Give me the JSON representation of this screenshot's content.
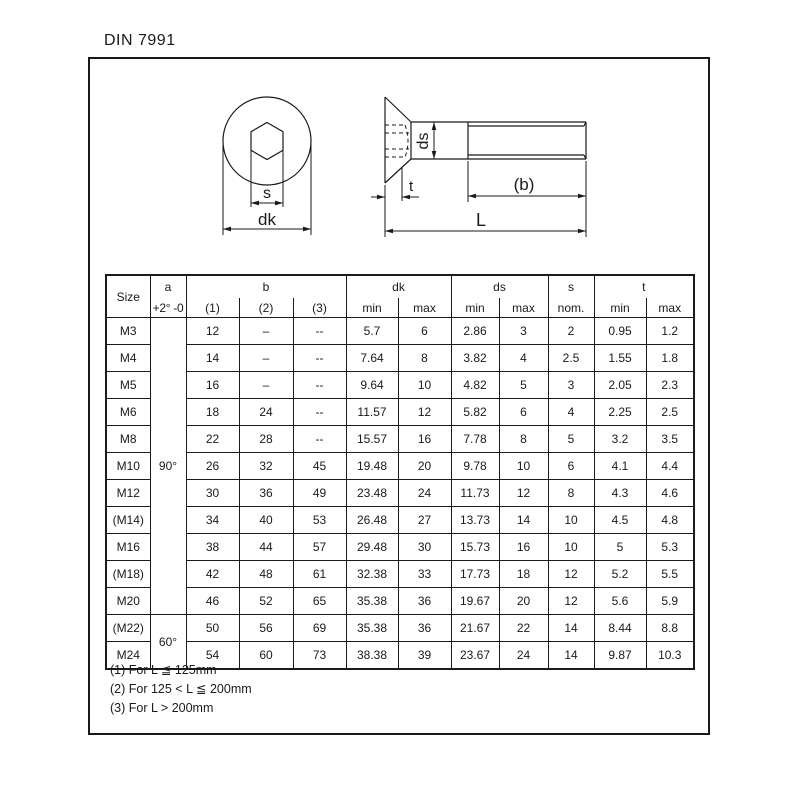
{
  "title": "DIN 7991",
  "drawing": {
    "top_view": {
      "s": "s",
      "dk": "dk"
    },
    "side_view": {
      "ds": "ds",
      "t": "t",
      "b": "(b)",
      "L": "L"
    }
  },
  "table": {
    "headers": {
      "size": "Size",
      "a": "a",
      "a_sub": "+2° -0",
      "b": "b",
      "b_subs": [
        "(1)",
        "(2)",
        "(3)"
      ],
      "dk": "dk",
      "ds": "ds",
      "s": "s",
      "t": "t",
      "minmax": [
        "min",
        "max"
      ],
      "s_sub": "nom."
    },
    "a_groups": [
      {
        "label": "90°",
        "rows": 11
      },
      {
        "label": "60°",
        "rows": 2
      }
    ],
    "rows": [
      {
        "size": "M3",
        "b1": "12",
        "b2": "–",
        "b3": "--",
        "dk_min": "5.7",
        "dk_max": "6",
        "ds_min": "2.86",
        "ds_max": "3",
        "s": "2",
        "t_min": "0.95",
        "t_max": "1.2"
      },
      {
        "size": "M4",
        "b1": "14",
        "b2": "–",
        "b3": "--",
        "dk_min": "7.64",
        "dk_max": "8",
        "ds_min": "3.82",
        "ds_max": "4",
        "s": "2.5",
        "t_min": "1.55",
        "t_max": "1.8"
      },
      {
        "size": "M5",
        "b1": "16",
        "b2": "–",
        "b3": "--",
        "dk_min": "9.64",
        "dk_max": "10",
        "ds_min": "4.82",
        "ds_max": "5",
        "s": "3",
        "t_min": "2.05",
        "t_max": "2.3"
      },
      {
        "size": "M6",
        "b1": "18",
        "b2": "24",
        "b3": "--",
        "dk_min": "11.57",
        "dk_max": "12",
        "ds_min": "5.82",
        "ds_max": "6",
        "s": "4",
        "t_min": "2.25",
        "t_max": "2.5"
      },
      {
        "size": "M8",
        "b1": "22",
        "b2": "28",
        "b3": "--",
        "dk_min": "15.57",
        "dk_max": "16",
        "ds_min": "7.78",
        "ds_max": "8",
        "s": "5",
        "t_min": "3.2",
        "t_max": "3.5"
      },
      {
        "size": "M10",
        "b1": "26",
        "b2": "32",
        "b3": "45",
        "dk_min": "19.48",
        "dk_max": "20",
        "ds_min": "9.78",
        "ds_max": "10",
        "s": "6",
        "t_min": "4.1",
        "t_max": "4.4"
      },
      {
        "size": "M12",
        "b1": "30",
        "b2": "36",
        "b3": "49",
        "dk_min": "23.48",
        "dk_max": "24",
        "ds_min": "11.73",
        "ds_max": "12",
        "s": "8",
        "t_min": "4.3",
        "t_max": "4.6"
      },
      {
        "size": "(M14)",
        "b1": "34",
        "b2": "40",
        "b3": "53",
        "dk_min": "26.48",
        "dk_max": "27",
        "ds_min": "13.73",
        "ds_max": "14",
        "s": "10",
        "t_min": "4.5",
        "t_max": "4.8"
      },
      {
        "size": "M16",
        "b1": "38",
        "b2": "44",
        "b3": "57",
        "dk_min": "29.48",
        "dk_max": "30",
        "ds_min": "15.73",
        "ds_max": "16",
        "s": "10",
        "t_min": "5",
        "t_max": "5.3"
      },
      {
        "size": "(M18)",
        "b1": "42",
        "b2": "48",
        "b3": "61",
        "dk_min": "32.38",
        "dk_max": "33",
        "ds_min": "17.73",
        "ds_max": "18",
        "s": "12",
        "t_min": "5.2",
        "t_max": "5.5"
      },
      {
        "size": "M20",
        "b1": "46",
        "b2": "52",
        "b3": "65",
        "dk_min": "35.38",
        "dk_max": "36",
        "ds_min": "19.67",
        "ds_max": "20",
        "s": "12",
        "t_min": "5.6",
        "t_max": "5.9"
      },
      {
        "size": "(M22)",
        "b1": "50",
        "b2": "56",
        "b3": "69",
        "dk_min": "35.38",
        "dk_max": "36",
        "ds_min": "21.67",
        "ds_max": "22",
        "s": "14",
        "t_min": "8.44",
        "t_max": "8.8"
      },
      {
        "size": "M24",
        "b1": "54",
        "b2": "60",
        "b3": "73",
        "dk_min": "38.38",
        "dk_max": "39",
        "ds_min": "23.67",
        "ds_max": "24",
        "s": "14",
        "t_min": "9.87",
        "t_max": "10.3"
      }
    ]
  },
  "footnotes": [
    "(1) For L ≦ 125mm",
    "(2) For 125 < L ≦ 200mm",
    "(3) For L > 200mm"
  ],
  "colors": {
    "line": "#1a1a1a",
    "background": "#ffffff"
  }
}
